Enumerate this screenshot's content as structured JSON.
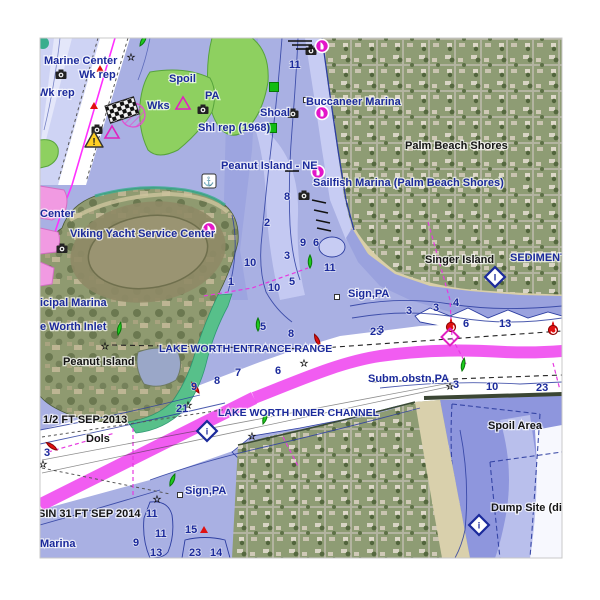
{
  "map": {
    "chart_name": "Lake Worth Inlet nautical chart with satellite overlay",
    "colors": {
      "water_lavender": "#a9b0e3",
      "water_mid": "#9aa2de",
      "water_light": "#c7ccf3",
      "water_pale": "#ced3f4",
      "channel_white": "#ffffff",
      "shoal_green": "#8ed060",
      "teal_band": "#39ae8e",
      "icw_magenta": "#ee3fee",
      "magenta_line": "#ff30ff",
      "label_navy": "#1b2a9b",
      "label_black": "#141414",
      "contour_navy": "#2c3da0",
      "marina_magenta": "#e316c9",
      "buoy_green": "#1ecb1e",
      "buoy_red": "#e01010",
      "warning_yellow": "#ffd024",
      "suburb_green": "#8e9c74",
      "sand": "#d9d0ac",
      "urban_pink": "#f19ae2"
    },
    "place_labels": [
      {
        "text": "Marine Center",
        "x": 44,
        "y": 64,
        "c": "navy"
      },
      {
        "text": "Wk rep",
        "x": 79,
        "y": 78,
        "c": "navy"
      },
      {
        "text": "Wk rep",
        "x": 38,
        "y": 96,
        "c": "navy"
      },
      {
        "text": "Spoil",
        "x": 169,
        "y": 82,
        "c": "navy"
      },
      {
        "text": "Wks",
        "x": 147,
        "y": 109,
        "c": "navy"
      },
      {
        "text": "PA",
        "x": 205,
        "y": 99,
        "c": "navy"
      },
      {
        "text": "Shoal",
        "x": 260,
        "y": 116,
        "c": "navy"
      },
      {
        "text": "Shl rep (1968)",
        "x": 198,
        "y": 131,
        "c": "navy"
      },
      {
        "text": "Buccaneer Marina",
        "x": 306,
        "y": 105,
        "c": "navy"
      },
      {
        "text": "Peanut Island - NE",
        "x": 221,
        "y": 169,
        "c": "navy"
      },
      {
        "text": "Sailfish Marina (Palm Beach Shores)",
        "x": 313,
        "y": 186,
        "c": "navy"
      },
      {
        "text": "Palm Beach Shores",
        "x": 405,
        "y": 149,
        "c": "black"
      },
      {
        "text": "Singer Island",
        "x": 425,
        "y": 263,
        "c": "black"
      },
      {
        "text": "SEDIMENT",
        "x": 510,
        "y": 261,
        "c": "navy"
      },
      {
        "text": "Center",
        "x": 40,
        "y": 217,
        "c": "navy"
      },
      {
        "text": "Viking Yacht Service Center",
        "x": 70,
        "y": 237,
        "c": "navy"
      },
      {
        "text": "icipal Marina",
        "x": 40,
        "y": 306,
        "c": "navy"
      },
      {
        "text": "e Worth Inlet",
        "x": 40,
        "y": 330,
        "c": "navy"
      },
      {
        "text": "Peanut Island",
        "x": 63,
        "y": 365,
        "c": "black"
      },
      {
        "text": "LAKE WORTH ENTRANCE RANGE",
        "x": 159,
        "y": 352,
        "c": "navy",
        "sz": 10.5
      },
      {
        "text": "Sign,PA",
        "x": 348,
        "y": 297,
        "c": "navy"
      },
      {
        "text": "Subm obstn,PA",
        "x": 368,
        "y": 382,
        "c": "navy"
      },
      {
        "text": "1/2 FT SEP 2013",
        "x": 43,
        "y": 423,
        "c": "black"
      },
      {
        "text": "Dols",
        "x": 86,
        "y": 442,
        "c": "black"
      },
      {
        "text": "LAKE WORTH INNER CHANNEL",
        "x": 218,
        "y": 416,
        "c": "navy",
        "sz": 10.5
      },
      {
        "text": "Sign,PA",
        "x": 185,
        "y": 494,
        "c": "navy"
      },
      {
        "text": "Spoil Area",
        "x": 488,
        "y": 429,
        "c": "black"
      },
      {
        "text": "Dump Site (di",
        "x": 491,
        "y": 511,
        "c": "black"
      },
      {
        "text": "SIN 31 FT SEP 2014",
        "x": 38,
        "y": 517,
        "c": "black"
      },
      {
        "text": "Marina",
        "x": 40,
        "y": 547,
        "c": "navy"
      }
    ],
    "depth_numbers": [
      {
        "v": "11",
        "x": 289,
        "y": 68
      },
      {
        "v": "8",
        "x": 284,
        "y": 200
      },
      {
        "v": "2",
        "x": 264,
        "y": 226
      },
      {
        "v": "9",
        "x": 300,
        "y": 246
      },
      {
        "v": "6",
        "x": 313,
        "y": 246
      },
      {
        "v": "3",
        "x": 284,
        "y": 259
      },
      {
        "v": "10",
        "x": 244,
        "y": 266
      },
      {
        "v": "11",
        "x": 324,
        "y": 271
      },
      {
        "v": "1",
        "x": 228,
        "y": 285
      },
      {
        "v": "5",
        "x": 289,
        "y": 285
      },
      {
        "v": "10",
        "x": 268,
        "y": 291
      },
      {
        "v": "5",
        "x": 260,
        "y": 330
      },
      {
        "v": "8",
        "x": 288,
        "y": 337
      },
      {
        "v": "23",
        "x": 370,
        "y": 335
      },
      {
        "v": "7",
        "x": 235,
        "y": 376
      },
      {
        "v": "6",
        "x": 275,
        "y": 374
      },
      {
        "v": "8",
        "x": 214,
        "y": 384
      },
      {
        "v": "9",
        "x": 191,
        "y": 390
      },
      {
        "v": "21",
        "x": 176,
        "y": 412
      },
      {
        "v": "3",
        "x": 406,
        "y": 314
      },
      {
        "v": "3",
        "x": 433,
        "y": 311
      },
      {
        "v": "4",
        "x": 453,
        "y": 306
      },
      {
        "v": "6",
        "x": 463,
        "y": 327
      },
      {
        "v": "13",
        "x": 499,
        "y": 327
      },
      {
        "v": "3",
        "x": 378,
        "y": 333
      },
      {
        "v": "3",
        "x": 453,
        "y": 388
      },
      {
        "v": "10",
        "x": 486,
        "y": 390
      },
      {
        "v": "23",
        "x": 536,
        "y": 391
      },
      {
        "v": "3",
        "x": 44,
        "y": 456
      },
      {
        "v": "11",
        "x": 146,
        "y": 517
      },
      {
        "v": "11",
        "x": 155,
        "y": 537
      },
      {
        "v": "9",
        "x": 133,
        "y": 546
      },
      {
        "v": "13",
        "x": 150,
        "y": 556
      },
      {
        "v": "15",
        "x": 185,
        "y": 533
      },
      {
        "v": "23",
        "x": 189,
        "y": 556
      },
      {
        "v": "14",
        "x": 210,
        "y": 556
      }
    ],
    "green_buoys": [
      {
        "x": 140,
        "y": 46,
        "rot": 30
      },
      {
        "x": 310,
        "y": 268,
        "rot": 0
      },
      {
        "x": 118,
        "y": 335,
        "rot": 12
      },
      {
        "x": 258,
        "y": 331,
        "rot": 0
      },
      {
        "x": 263,
        "y": 424,
        "rot": 18
      },
      {
        "x": 170,
        "y": 486,
        "rot": 22
      },
      {
        "x": 462,
        "y": 371,
        "rot": 10
      }
    ],
    "red_buoys": [
      {
        "x": 199,
        "y": 393,
        "rot": -35
      },
      {
        "x": 57,
        "y": 450,
        "rot": -55
      },
      {
        "x": 320,
        "y": 346,
        "rot": -25
      }
    ],
    "lighted_buoys": [
      {
        "x": 451,
        "y": 327
      },
      {
        "x": 553,
        "y": 330
      }
    ],
    "red_triangles": [
      {
        "x": 100,
        "y": 69
      },
      {
        "x": 94,
        "y": 106
      },
      {
        "x": 204,
        "y": 530
      }
    ],
    "stars": [
      {
        "x": 131,
        "y": 57
      },
      {
        "x": 105,
        "y": 346
      },
      {
        "x": 304,
        "y": 363
      },
      {
        "x": 188,
        "y": 405
      },
      {
        "x": 252,
        "y": 436
      },
      {
        "x": 43,
        "y": 464
      },
      {
        "x": 157,
        "y": 499
      },
      {
        "x": 450,
        "y": 386
      }
    ],
    "green_squares": [
      {
        "x": 274,
        "y": 87
      },
      {
        "x": 272,
        "y": 128
      }
    ],
    "cameras": [
      {
        "x": 61,
        "y": 75
      },
      {
        "x": 203,
        "y": 110
      },
      {
        "x": 293,
        "y": 114
      },
      {
        "x": 311,
        "y": 51
      },
      {
        "x": 304,
        "y": 196
      },
      {
        "x": 62,
        "y": 249
      },
      {
        "x": 97,
        "y": 130
      }
    ],
    "marinas": [
      {
        "x": 322,
        "y": 46
      },
      {
        "x": 322,
        "y": 113
      },
      {
        "x": 318,
        "y": 172
      },
      {
        "x": 209,
        "y": 229
      }
    ],
    "info_diamonds": [
      {
        "x": 495,
        "y": 277,
        "ch": "I"
      },
      {
        "x": 207,
        "y": 431,
        "ch": "i"
      },
      {
        "x": 479,
        "y": 525,
        "ch": "i"
      }
    ],
    "anchorages": [
      {
        "x": 209,
        "y": 181,
        "glyph": "⚓"
      }
    ],
    "small_squares": [
      {
        "x": 337,
        "y": 297
      },
      {
        "x": 180,
        "y": 495
      },
      {
        "x": 306,
        "y": 100
      }
    ],
    "magenta_triangles": [
      {
        "x": 112,
        "y": 133
      },
      {
        "x": 183,
        "y": 104
      }
    ],
    "magenta_diamonds": [
      {
        "x": 450,
        "y": 337
      }
    ],
    "hatched_circles": [
      {
        "x": 133,
        "y": 115
      }
    ],
    "checkered_flag": {
      "x": 122,
      "y": 110,
      "rot": -18
    },
    "warning": {
      "x": 94,
      "y": 140,
      "glyph": "!"
    },
    "piers": [
      [
        288,
        41,
        312,
        41
      ],
      [
        292,
        45,
        312,
        45
      ],
      [
        296,
        49,
        312,
        49
      ],
      [
        285,
        171,
        299,
        171
      ],
      [
        312,
        200,
        326,
        203
      ],
      [
        314,
        210,
        328,
        213
      ],
      [
        316,
        220,
        330,
        223
      ],
      [
        317,
        228,
        331,
        231
      ]
    ]
  }
}
